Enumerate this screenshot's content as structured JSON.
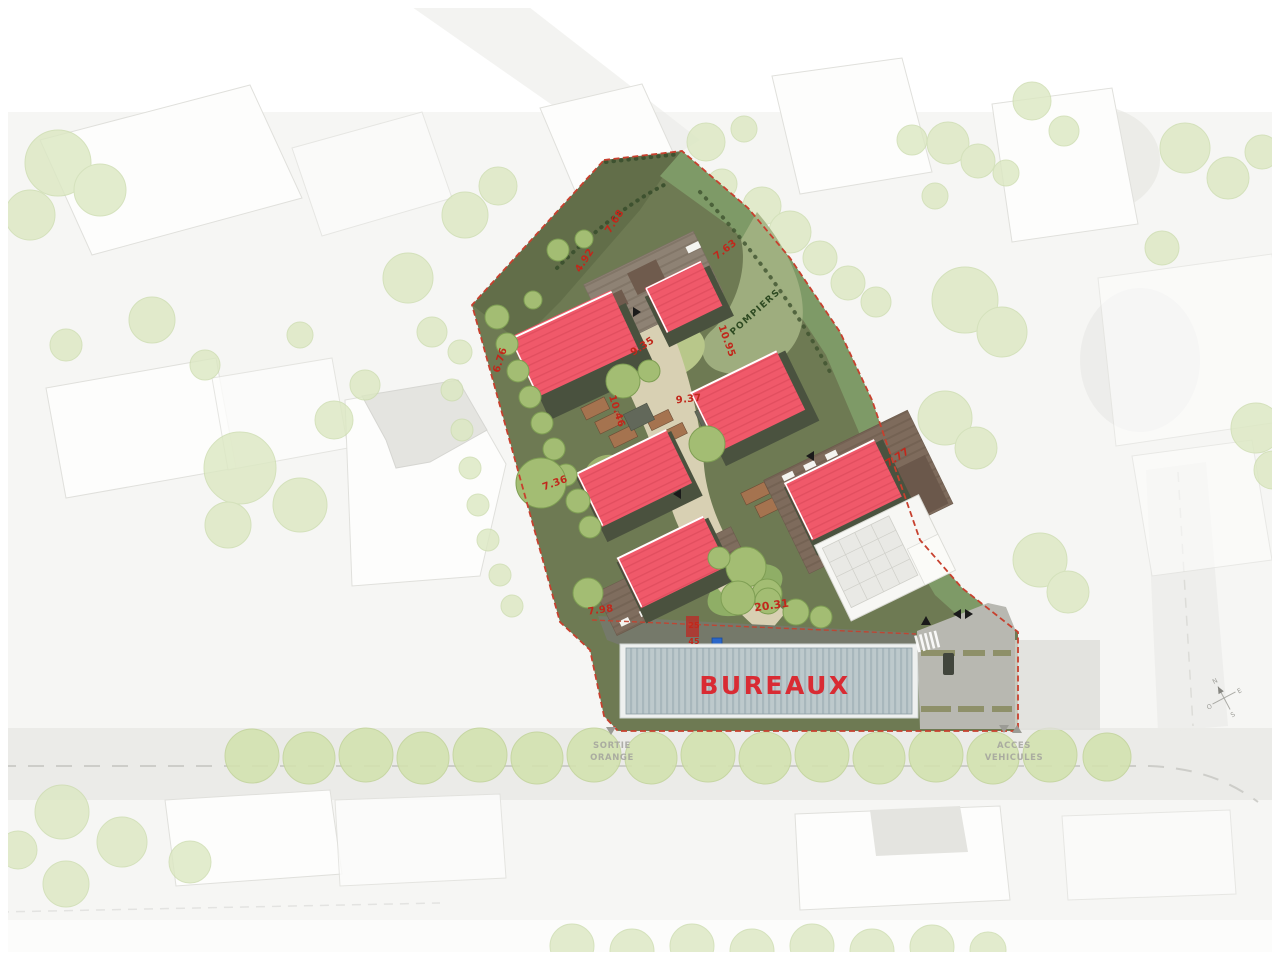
{
  "labels": {
    "bureaux": "BUREAUX",
    "pompiers": "POMPIERS",
    "sortie_line1": "SORTIE",
    "sortie_line2": "ORANGE",
    "acces_line1": "ACCES",
    "acces_line2": "VEHICULES",
    "compass_n": "N",
    "compass_e": "E",
    "compass_s": "S",
    "compass_o": "O"
  },
  "dimensions": {
    "d_768": "7.68",
    "d_492": "4.92",
    "d_763": "7.63",
    "d_1095": "10.95",
    "d_935": "9.35",
    "d_1046": "10.46",
    "d_937": "9.37",
    "d_777": "7.77",
    "d_676": "6.76",
    "d_736": "7.36",
    "d_798": "7.98",
    "d_2031": "20.31",
    "d_25": "25",
    "d_45": "45"
  },
  "colors": {
    "roof_red": "#f0596a",
    "boundary_red": "#c7402e",
    "dimension_red": "#c1271b",
    "bureaux_text": "#d92b33",
    "pompiers_text": "#2e4a22",
    "site_green": "#6e7a53",
    "band_green": "#7e9a67",
    "path_beige": "#d8d0b3",
    "bureaux_roof": "#bdc9cc",
    "muted_label_gray": "#a3a39d"
  }
}
